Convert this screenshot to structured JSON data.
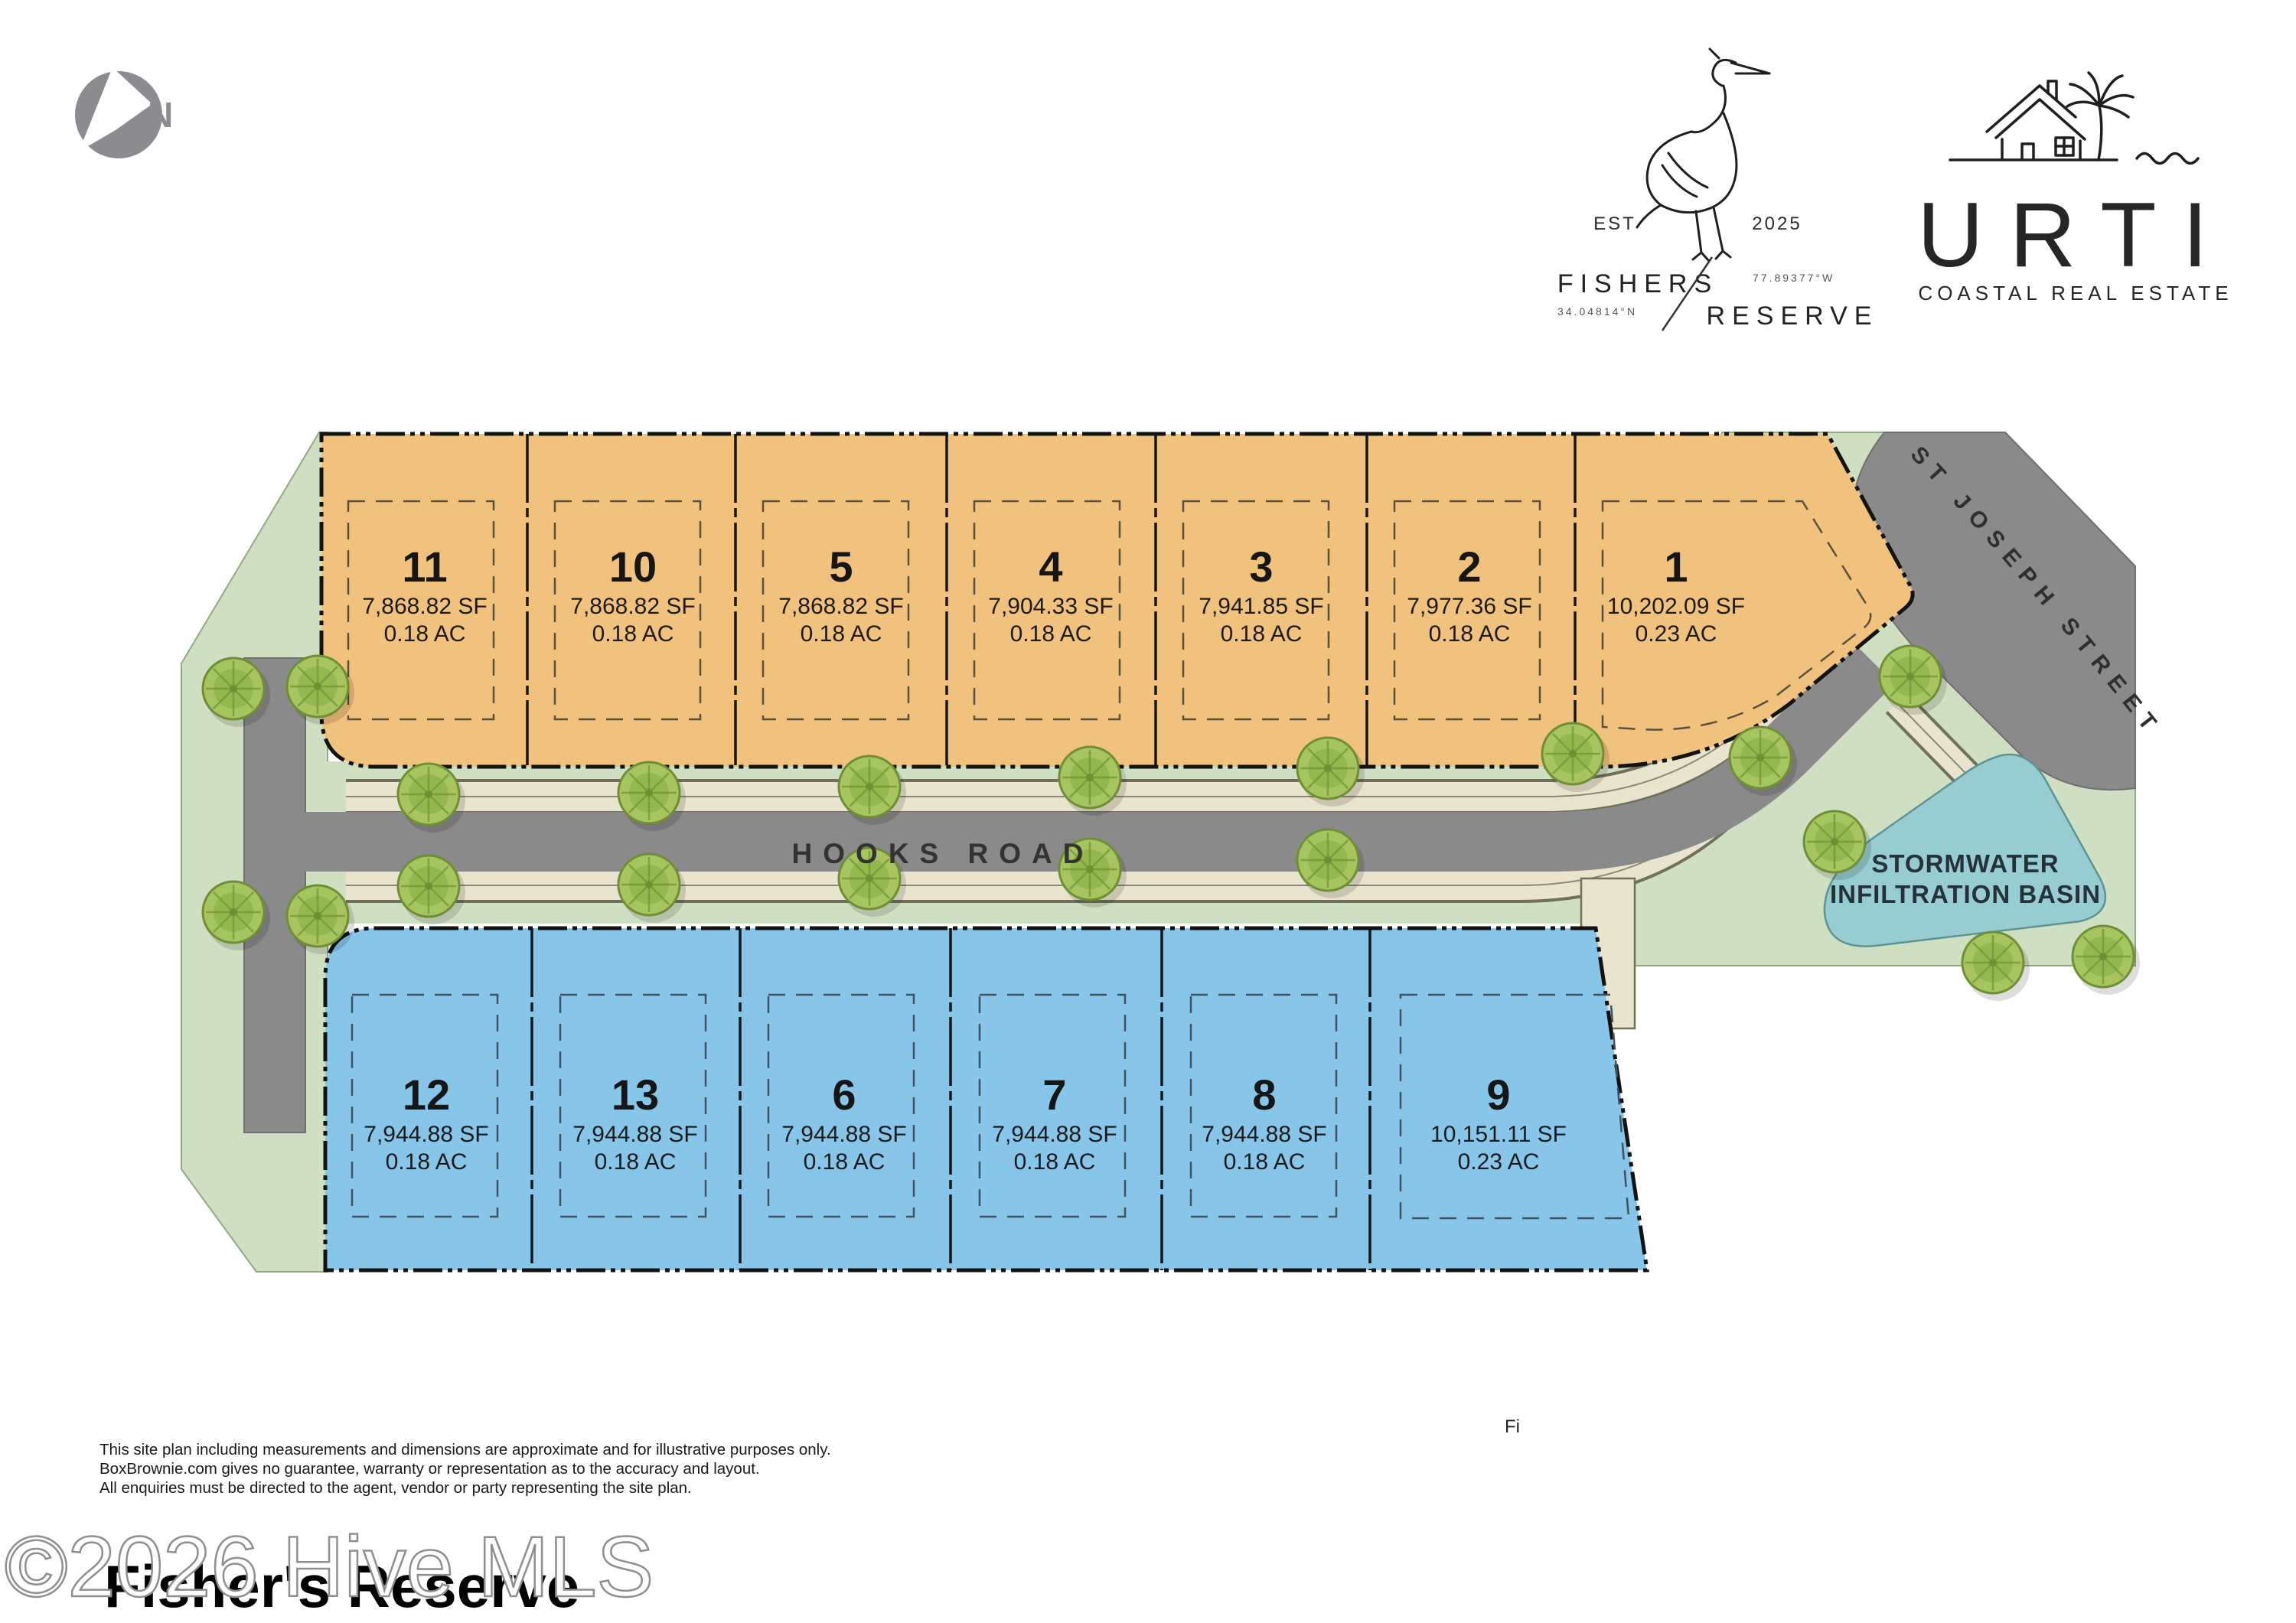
{
  "north_arrow": {
    "label": "N"
  },
  "fishers_logo": {
    "est": "EST",
    "year": "2025",
    "name_line1": "FISHERS",
    "name_line2": "RESERVE",
    "longitude": "77.89377°W",
    "latitude": "34.04814°N"
  },
  "urti_logo": {
    "name": "URTI",
    "tagline": "COASTAL REAL ESTATE"
  },
  "site_plan": {
    "roads": {
      "hooks_road": "HOOKS ROAD",
      "st_joseph_street": "ST JOSEPH STREET"
    },
    "basin": {
      "label_line1": "STORMWATER",
      "label_line2": "INFILTRATION BASIN"
    },
    "lots": [
      {
        "number": "11",
        "area_sf": "7,868.82 SF",
        "area_ac": "0.18 AC"
      },
      {
        "number": "10",
        "area_sf": "7,868.82 SF",
        "area_ac": "0.18 AC"
      },
      {
        "number": "5",
        "area_sf": "7,868.82 SF",
        "area_ac": "0.18 AC"
      },
      {
        "number": "4",
        "area_sf": "7,904.33 SF",
        "area_ac": "0.18 AC"
      },
      {
        "number": "3",
        "area_sf": "7,941.85 SF",
        "area_ac": "0.18 AC"
      },
      {
        "number": "2",
        "area_sf": "7,977.36 SF",
        "area_ac": "0.18 AC"
      },
      {
        "number": "1",
        "area_sf": "10,202.09 SF",
        "area_ac": "0.23 AC"
      },
      {
        "number": "12",
        "area_sf": "7,944.88 SF",
        "area_ac": "0.18 AC"
      },
      {
        "number": "13",
        "area_sf": "7,944.88 SF",
        "area_ac": "0.18 AC"
      },
      {
        "number": "6",
        "area_sf": "7,944.88 SF",
        "area_ac": "0.18 AC"
      },
      {
        "number": "7",
        "area_sf": "7,944.88 SF",
        "area_ac": "0.18 AC"
      },
      {
        "number": "8",
        "area_sf": "7,944.88 SF",
        "area_ac": "0.18 AC"
      },
      {
        "number": "9",
        "area_sf": "10,151.11 SF",
        "area_ac": "0.23 AC"
      }
    ]
  },
  "footer": {
    "disclaimer_line1": "This site plan including measurements and dimensions are approximate and for illustrative purposes only.",
    "disclaimer_line2": "BoxBrownie.com gives no guarantee, warranty or representation as to the accuracy and layout.",
    "disclaimer_line3": "All enquiries must be directed to the agent, vendor or party representing the site plan.",
    "stray_text": "Fi",
    "watermark": "©2026 Hive MLS",
    "title": "Fisher's Reserve"
  },
  "colors": {
    "lot_orange": "#F0C27E",
    "lot_blue": "#87C5E9",
    "road_gray": "#8A8A8A",
    "green": "#CFE0C2",
    "sidewalk_beige": "#E8E4CE",
    "basin_teal": "#97CDD1",
    "tree_green": "#A5C45C",
    "north_gray": "#8B8B90"
  }
}
